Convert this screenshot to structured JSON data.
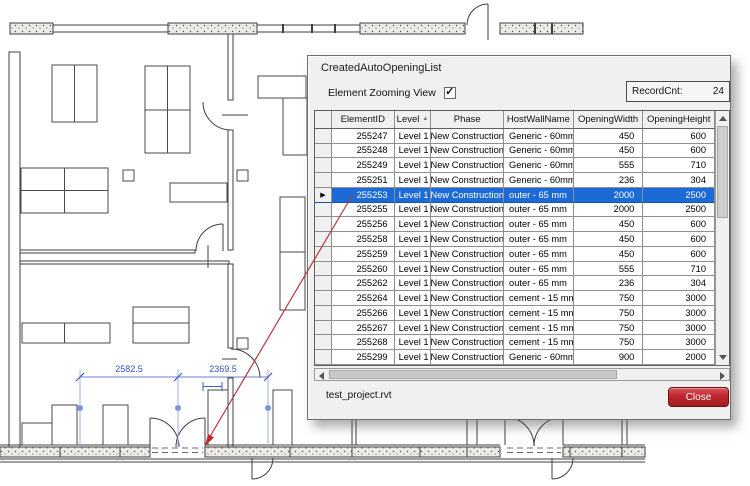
{
  "dialog": {
    "title": "CreatedAutoOpeningList",
    "checkbox_label": "Element Zooming View",
    "checkbox_checked": true,
    "checkbox_glyph": "✓",
    "record_cnt_label": "RecordCnt:",
    "record_cnt_value": "24",
    "file_name": "test_project.rvt",
    "close_label": "Close"
  },
  "table": {
    "columns": [
      "ElementID",
      "Level",
      "Phase",
      "HostWallName",
      "OpeningWidth",
      "OpeningHeight"
    ],
    "sort_icon": "▲",
    "selected_marker": "▶",
    "selected_index": 4,
    "rows": [
      {
        "id": "255247",
        "level": "Level 1",
        "phase": "New Construction",
        "host": "Generic - 60mm",
        "width": "450",
        "height": "600"
      },
      {
        "id": "255248",
        "level": "Level 1",
        "phase": "New Construction",
        "host": "Generic - 60mm",
        "width": "450",
        "height": "600"
      },
      {
        "id": "255249",
        "level": "Level 1",
        "phase": "New Construction",
        "host": "Generic - 60mm",
        "width": "555",
        "height": "710"
      },
      {
        "id": "255251",
        "level": "Level 1",
        "phase": "New Construction",
        "host": "Generic - 60mm",
        "width": "236",
        "height": "304"
      },
      {
        "id": "255253",
        "level": "Level 1",
        "phase": "New Construction",
        "host": "outer - 65 mm",
        "width": "2000",
        "height": "2500"
      },
      {
        "id": "255255",
        "level": "Level 1",
        "phase": "New Construction",
        "host": "outer - 65 mm",
        "width": "2000",
        "height": "2500"
      },
      {
        "id": "255256",
        "level": "Level 1",
        "phase": "New Construction",
        "host": "outer - 65 mm",
        "width": "450",
        "height": "600"
      },
      {
        "id": "255258",
        "level": "Level 1",
        "phase": "New Construction",
        "host": "outer - 65 mm",
        "width": "450",
        "height": "600"
      },
      {
        "id": "255259",
        "level": "Level 1",
        "phase": "New Construction",
        "host": "outer - 65 mm",
        "width": "450",
        "height": "600"
      },
      {
        "id": "255260",
        "level": "Level 1",
        "phase": "New Construction",
        "host": "outer - 65 mm",
        "width": "555",
        "height": "710"
      },
      {
        "id": "255262",
        "level": "Level 1",
        "phase": "New Construction",
        "host": "outer - 65 mm",
        "width": "236",
        "height": "304"
      },
      {
        "id": "255264",
        "level": "Level 1",
        "phase": "New Construction",
        "host": "cement - 15 mm",
        "width": "750",
        "height": "3000"
      },
      {
        "id": "255266",
        "level": "Level 1",
        "phase": "New Construction",
        "host": "cement - 15 mm",
        "width": "750",
        "height": "3000"
      },
      {
        "id": "255267",
        "level": "Level 1",
        "phase": "New Construction",
        "host": "cement - 15 mm",
        "width": "750",
        "height": "3000"
      },
      {
        "id": "255268",
        "level": "Level 1",
        "phase": "New Construction",
        "host": "cement - 15 mm",
        "width": "750",
        "height": "3000"
      },
      {
        "id": "255299",
        "level": "Level 1",
        "phase": "New Construction",
        "host": "Generic - 60mm",
        "width": "900",
        "height": "2000"
      }
    ]
  },
  "plan": {
    "dimensions": [
      "2582.5",
      "2369.5"
    ]
  },
  "colors": {
    "selection_blue": "#1b6ad6",
    "close_red": "#c0272e",
    "dimension_blue": "#6a82d2",
    "leader_red": "#b5373f"
  }
}
